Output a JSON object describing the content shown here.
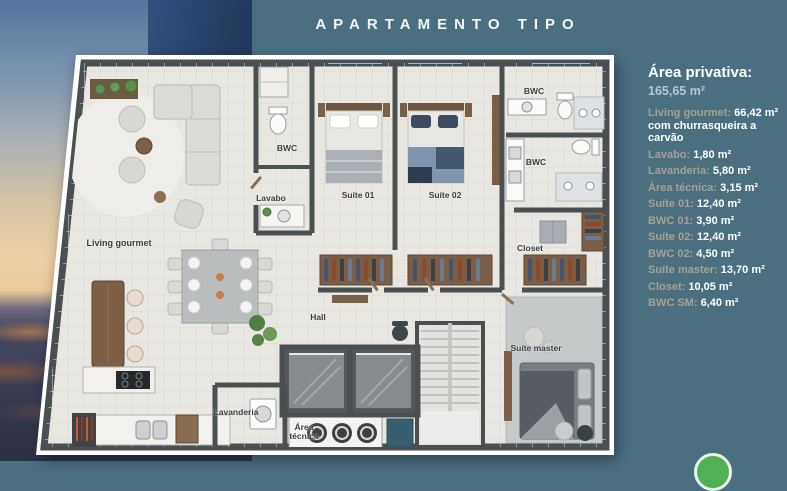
{
  "header": {
    "title": "APARTAMENTO TIPO"
  },
  "legend": {
    "title": "Área privativa:",
    "total": "165,65 m²",
    "items": [
      {
        "label": "Living gourmet:",
        "value": "66,42 m²",
        "note": "com churrasqueira a carvão"
      },
      {
        "label": "Lavabo:",
        "value": "1,80 m²"
      },
      {
        "label": "Lavanderia:",
        "value": "5,80 m²"
      },
      {
        "label": "Área técnica:",
        "value": "3,15 m²"
      },
      {
        "label": "Suíte 01:",
        "value": "12,40 m²"
      },
      {
        "label": "BWC 01:",
        "value": "3,90 m²"
      },
      {
        "label": "Suíte 02:",
        "value": "12,40 m²"
      },
      {
        "label": "BWC 02:",
        "value": "4,50 m²"
      },
      {
        "label": "Suíte master:",
        "value": "13,70 m²"
      },
      {
        "label": "Closet:",
        "value": "10,05 m²"
      },
      {
        "label": "BWC SM:",
        "value": "6,40 m²"
      }
    ]
  },
  "floorplan": {
    "rooms": [
      {
        "id": "living-gourmet",
        "label": "Living gourmet"
      },
      {
        "id": "bwc-social",
        "label": "BWC"
      },
      {
        "id": "lavabo",
        "label": "Lavabo"
      },
      {
        "id": "suite-01",
        "label": "Suíte 01"
      },
      {
        "id": "suite-02",
        "label": "Suíte 02"
      },
      {
        "id": "bwc-01",
        "label": "BWC"
      },
      {
        "id": "bwc-02",
        "label": "BWC"
      },
      {
        "id": "closet",
        "label": "Closet"
      },
      {
        "id": "suite-master",
        "label": "Suíte master"
      },
      {
        "id": "hall",
        "label": "Hall"
      },
      {
        "id": "lavanderia",
        "label": "Lavanderia"
      },
      {
        "id": "area-tecnica",
        "label": "Área técnica"
      }
    ]
  },
  "icons": {
    "whatsapp": "whatsapp-button"
  },
  "colors": {
    "background_teal": "#4a7080",
    "legend_label": "#a8a093",
    "legend_value": "#ffffff",
    "wall": "#4a5052",
    "floor": "#e9e7e2",
    "wood": "#7a5e46",
    "window_glass": "#8ec2d0",
    "whatsapp_green": "#50b154"
  }
}
